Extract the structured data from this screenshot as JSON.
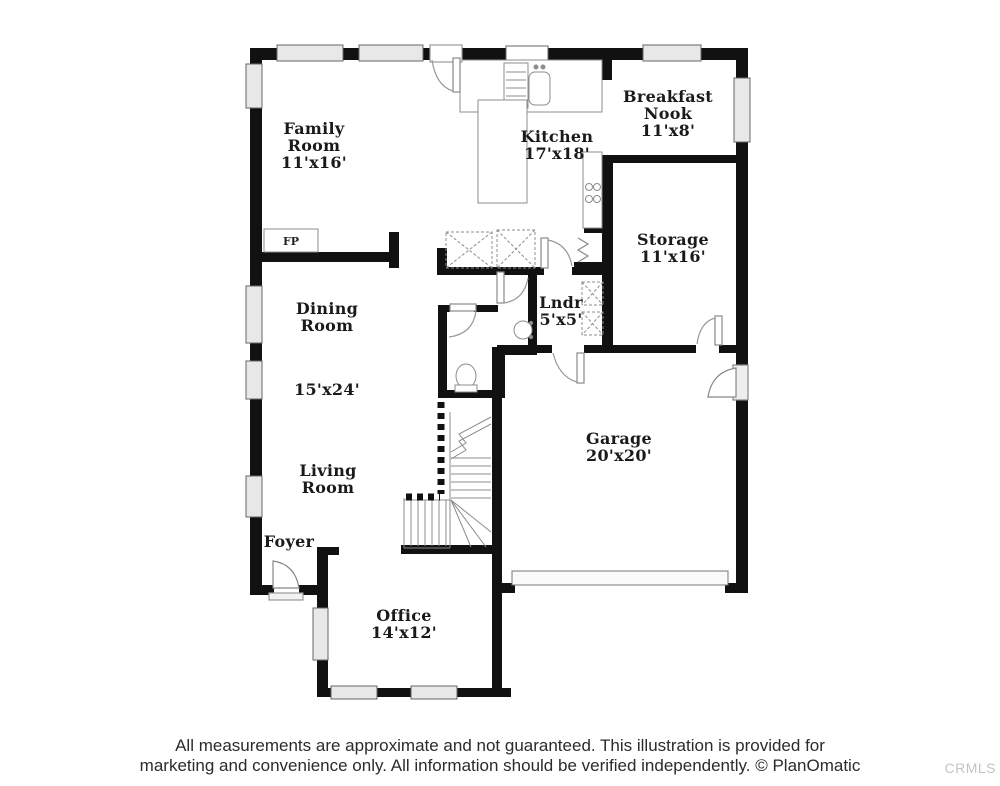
{
  "plan": {
    "rooms": [
      {
        "id": "family-room",
        "name": "Family Room",
        "dims": "11'x16'"
      },
      {
        "id": "kitchen",
        "name": "Kitchen",
        "dims": "17'x18'"
      },
      {
        "id": "breakfast-nook",
        "name": "Breakfast Nook",
        "dims": "11'x8'"
      },
      {
        "id": "storage",
        "name": "Storage",
        "dims": "11'x16'"
      },
      {
        "id": "dining-room",
        "name": "Dining Room",
        "dims": "15'x24'"
      },
      {
        "id": "living-room",
        "name": "Living Room",
        "dims": ""
      },
      {
        "id": "laundry",
        "name": "Lndr",
        "dims": "5'x5'"
      },
      {
        "id": "garage",
        "name": "Garage",
        "dims": "20'x20'"
      },
      {
        "id": "foyer",
        "name": "Foyer",
        "dims": ""
      },
      {
        "id": "office",
        "name": "Office",
        "dims": "14'x12'"
      }
    ],
    "fireplace_label": "FP",
    "colors": {
      "wall": "#111111",
      "window_fill": "#e8e8e8",
      "fixture_stroke": "#8c8c8c",
      "watermark": "#c4c4c4"
    }
  },
  "footer": {
    "line1": "All measurements are approximate and not guaranteed. This illustration is provided for",
    "line2": "marketing and convenience only. All information should be verified independently. © PlanOmatic"
  },
  "watermark": "CRMLS"
}
